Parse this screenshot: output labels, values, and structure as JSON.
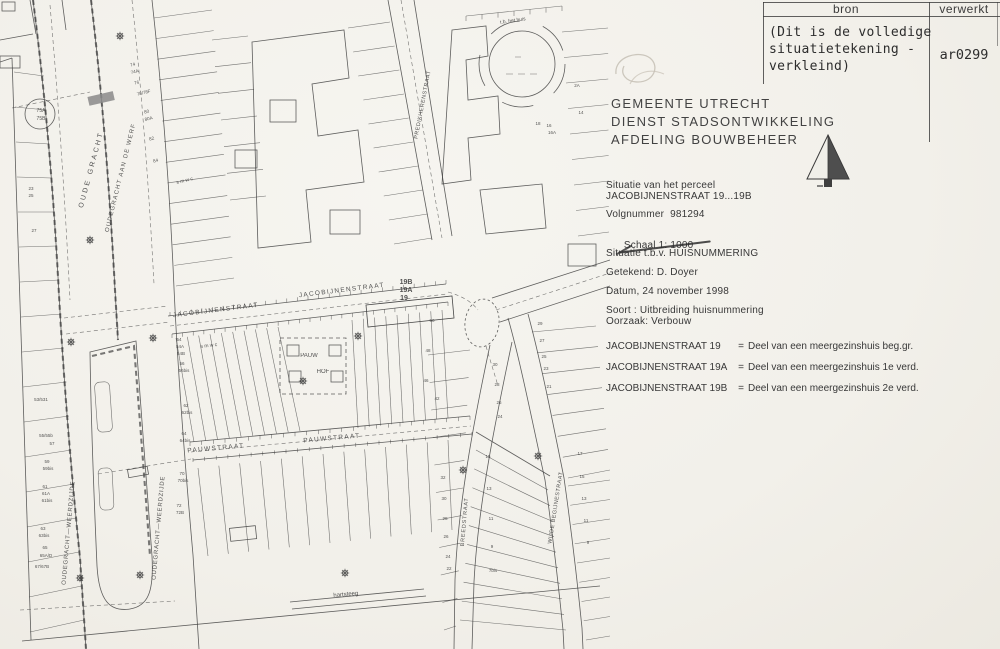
{
  "form": {
    "table": {
      "header_bron": "bron",
      "header_verwerkt": "verwerkt",
      "note_line1": "(Dit is de volledige",
      "note_line2": "situatietekening -",
      "note_line3": "verkleind)",
      "code": "ar0299"
    },
    "org_line1": "GEMEENTE  UTRECHT",
    "org_line2": "DIENST  STADSONTWIKKELING",
    "org_line3": "AFDELING  BOUWBEHEER",
    "north_arrow": "north-arrow-icon",
    "situatie_label": "Situatie van het perceel",
    "situatie_value": "JACOBIJNENSTRAAT 19...19B",
    "volgnummer": "Volgnummer  981294",
    "schaal_label": "Schaal",
    "schaal_value": "1: 1000",
    "tbv": "Situatie t.b.v. HUISNUMMERING",
    "getekend": "Getekend: D. Doyer",
    "datum": "Datum, 24 november 1998",
    "soort": "Soort : Uitbreiding huisnummering",
    "oorzaak": "Oorzaak: Verbouw",
    "entries": [
      {
        "addr": "JACOBIJNENSTRAAT 19",
        "sep": "=",
        "desc": "Deel van een meergezinshuis beg.gr."
      },
      {
        "addr": "JACOBIJNENSTRAAT 19A",
        "sep": "=",
        "desc": "Deel van een meergezinshuis 1e verd."
      },
      {
        "addr": "JACOBIJNENSTRAAT 19B",
        "sep": "=",
        "desc": "Deel van een meergezinshuis 2e verd."
      }
    ]
  },
  "map": {
    "ink": "#3c3c3c",
    "labels": [
      {
        "t": "OUDE GRACHT",
        "x": 93,
        "y": 170,
        "r": -75,
        "s": 7,
        "ls": 2.5
      },
      {
        "t": "OUDEGRACHT AAN DE WERF",
        "x": 122,
        "y": 178,
        "r": -76,
        "s": 6,
        "ls": 1.2
      },
      {
        "t": "OUDEGRACHT—WEERDZIJDE",
        "x": 70,
        "y": 533,
        "r": -85,
        "s": 6,
        "ls": 0.8
      },
      {
        "t": "OUDEGRACHT—WEERDZIJDE",
        "x": 160,
        "y": 528,
        "r": -85,
        "s": 6,
        "ls": 0.8
      },
      {
        "t": "JACOBIJNENSTRAAT",
        "x": 216,
        "y": 312,
        "r": -7,
        "s": 6.5,
        "ls": 1.3
      },
      {
        "t": "JACOBIJNENSTRAAT",
        "x": 342,
        "y": 292,
        "r": -7,
        "s": 6.5,
        "ls": 1.3
      },
      {
        "t": "PAUWSTRAAT",
        "x": 216,
        "y": 450,
        "r": -5,
        "s": 6.5,
        "ls": 1.3
      },
      {
        "t": "PAUWSTRAAT",
        "x": 332,
        "y": 440,
        "r": -5,
        "s": 6.5,
        "ls": 1.3
      },
      {
        "t": "PREDIKHERENSTRAAT",
        "x": 424,
        "y": 105,
        "r": -79,
        "s": 5.5,
        "ls": 0.5
      },
      {
        "t": "BREEDSTRAAT",
        "x": 466,
        "y": 522,
        "r": -85,
        "s": 5.5,
        "ls": 0.8
      },
      {
        "t": "WIJDE BEGIJNESTRAAT",
        "x": 557,
        "y": 508,
        "r": -81,
        "s": 5.5,
        "ls": 0.5
      },
      {
        "t": "hartsteeg",
        "x": 346,
        "y": 596,
        "r": -5,
        "s": 6
      },
      {
        "t": "PAUW",
        "x": 309,
        "y": 357,
        "s": 6
      },
      {
        "t": "HOF",
        "x": 323,
        "y": 373,
        "s": 6
      },
      {
        "t": "19B",
        "x": 406,
        "y": 284,
        "s": 7,
        "w": 700
      },
      {
        "t": "19A",
        "x": 406,
        "y": 292,
        "s": 7,
        "w": 700
      },
      {
        "t": "19",
        "x": 404,
        "y": 300,
        "s": 7,
        "w": 700
      },
      {
        "t": "t.b. het huis",
        "x": 513,
        "y": 22,
        "r": -8,
        "s": 5
      },
      {
        "t": "75A",
        "x": 41,
        "y": 112,
        "s": 5
      },
      {
        "t": "75B",
        "x": 41,
        "y": 120,
        "s": 5
      },
      {
        "t": "s m w c",
        "x": 185,
        "y": 182,
        "r": -14,
        "s": 5
      },
      {
        "t": "s m w c",
        "x": 209,
        "y": 347,
        "r": -7,
        "s": 5
      },
      {
        "t": "23",
        "x": 31,
        "y": 190,
        "s": 4.5
      },
      {
        "t": "25",
        "x": 31,
        "y": 197,
        "s": 4.5
      },
      {
        "t": "27",
        "x": 34,
        "y": 232,
        "s": 4.5
      },
      {
        "t": "53/531",
        "x": 41,
        "y": 401,
        "s": 4.5
      },
      {
        "t": "55/55b",
        "x": 46,
        "y": 437,
        "s": 4.5
      },
      {
        "t": "57",
        "x": 52,
        "y": 445,
        "s": 4.5
      },
      {
        "t": "59",
        "x": 47,
        "y": 463,
        "s": 4.5
      },
      {
        "t": "59bis",
        "x": 48,
        "y": 470,
        "s": 4.5
      },
      {
        "t": "61",
        "x": 45,
        "y": 488,
        "s": 4.5
      },
      {
        "t": "61A",
        "x": 46,
        "y": 495,
        "s": 4.5
      },
      {
        "t": "61bis",
        "x": 47,
        "y": 502,
        "s": 4.5
      },
      {
        "t": "63",
        "x": 43,
        "y": 530,
        "s": 4.5
      },
      {
        "t": "63bis",
        "x": 44,
        "y": 537,
        "s": 4.5
      },
      {
        "t": "65",
        "x": 45,
        "y": 549,
        "s": 4.5
      },
      {
        "t": "65A/D",
        "x": 46,
        "y": 557,
        "s": 4.5
      },
      {
        "t": "67/67B",
        "x": 42,
        "y": 568,
        "s": 4.5
      },
      {
        "t": "74",
        "x": 133,
        "y": 66,
        "r": -14,
        "s": 4.5
      },
      {
        "t": "74A",
        "x": 135,
        "y": 73,
        "r": -14,
        "s": 4.5
      },
      {
        "t": "76",
        "x": 137,
        "y": 84,
        "r": -14,
        "s": 4.5
      },
      {
        "t": "78/78F",
        "x": 144,
        "y": 94,
        "r": -14,
        "s": 4.5
      },
      {
        "t": "80",
        "x": 147,
        "y": 113,
        "r": -14,
        "s": 4.5
      },
      {
        "t": "80A",
        "x": 149,
        "y": 120,
        "r": -14,
        "s": 4.5
      },
      {
        "t": "82",
        "x": 152,
        "y": 140,
        "r": -14,
        "s": 4.5
      },
      {
        "t": "84",
        "x": 156,
        "y": 162,
        "r": -14,
        "s": 4.5
      },
      {
        "t": "54",
        "x": 179,
        "y": 341,
        "s": 4.5
      },
      {
        "t": "54A",
        "x": 180,
        "y": 348,
        "s": 4.5
      },
      {
        "t": "54B",
        "x": 181,
        "y": 355,
        "s": 4.5
      },
      {
        "t": "56",
        "x": 182,
        "y": 365,
        "s": 4.5
      },
      {
        "t": "56bis",
        "x": 184,
        "y": 372,
        "s": 4.5
      },
      {
        "t": "62",
        "x": 186,
        "y": 407,
        "s": 4.5
      },
      {
        "t": "62bis",
        "x": 187,
        "y": 414,
        "s": 4.5
      },
      {
        "t": "64",
        "x": 184,
        "y": 435,
        "s": 4.5
      },
      {
        "t": "64bis",
        "x": 185,
        "y": 442,
        "s": 4.5
      },
      {
        "t": "70",
        "x": 182,
        "y": 475,
        "s": 4.5
      },
      {
        "t": "70bis",
        "x": 183,
        "y": 482,
        "s": 4.5
      },
      {
        "t": "72",
        "x": 179,
        "y": 507,
        "s": 4.5
      },
      {
        "t": "72B",
        "x": 180,
        "y": 514,
        "s": 4.5
      },
      {
        "t": "50",
        "x": 432,
        "y": 322,
        "s": 4.5
      },
      {
        "t": "48",
        "x": 428,
        "y": 352,
        "s": 4.5
      },
      {
        "t": "46",
        "x": 426,
        "y": 382,
        "s": 4.5
      },
      {
        "t": "42",
        "x": 437,
        "y": 400,
        "s": 4.5
      },
      {
        "t": "30",
        "x": 495,
        "y": 366,
        "s": 4.5
      },
      {
        "t": "28",
        "x": 497,
        "y": 386,
        "s": 4.5
      },
      {
        "t": "26",
        "x": 499,
        "y": 404,
        "s": 4.5
      },
      {
        "t": "24",
        "x": 500,
        "y": 418,
        "s": 4.5
      },
      {
        "t": "29",
        "x": 540,
        "y": 325,
        "s": 4.5
      },
      {
        "t": "27",
        "x": 542,
        "y": 342,
        "s": 4.5
      },
      {
        "t": "25",
        "x": 544,
        "y": 358,
        "s": 4.5
      },
      {
        "t": "23",
        "x": 546,
        "y": 370,
        "s": 4.5
      },
      {
        "t": "21",
        "x": 549,
        "y": 388,
        "s": 4.5
      },
      {
        "t": "15",
        "x": 488,
        "y": 458,
        "s": 4.5
      },
      {
        "t": "13",
        "x": 489,
        "y": 490,
        "s": 4.5
      },
      {
        "t": "11",
        "x": 491,
        "y": 520,
        "s": 4.5
      },
      {
        "t": "9",
        "x": 492,
        "y": 548,
        "s": 4.5
      },
      {
        "t": "7bis",
        "x": 493,
        "y": 572,
        "s": 4.5
      },
      {
        "t": "17",
        "x": 580,
        "y": 455,
        "s": 4.5
      },
      {
        "t": "15",
        "x": 582,
        "y": 478,
        "s": 4.5
      },
      {
        "t": "13",
        "x": 584,
        "y": 500,
        "s": 4.5
      },
      {
        "t": "11",
        "x": 586,
        "y": 522,
        "s": 4.5
      },
      {
        "t": "9",
        "x": 588,
        "y": 544,
        "s": 4.5
      },
      {
        "t": "18",
        "x": 538,
        "y": 125,
        "s": 4.5
      },
      {
        "t": "16",
        "x": 549,
        "y": 127,
        "s": 4.5
      },
      {
        "t": "16A",
        "x": 552,
        "y": 134,
        "s": 4.5
      },
      {
        "t": "14",
        "x": 581,
        "y": 114,
        "s": 4.5
      },
      {
        "t": "2A",
        "x": 577,
        "y": 87,
        "s": 4.5
      },
      {
        "t": "32",
        "x": 443,
        "y": 479,
        "s": 4.5
      },
      {
        "t": "30",
        "x": 444,
        "y": 500,
        "s": 4.5
      },
      {
        "t": "28",
        "x": 445,
        "y": 520,
        "s": 4.5
      },
      {
        "t": "26",
        "x": 446,
        "y": 538,
        "s": 4.5
      },
      {
        "t": "24",
        "x": 448,
        "y": 558,
        "s": 4.5
      },
      {
        "t": "22",
        "x": 449,
        "y": 570,
        "s": 4.5
      }
    ],
    "trees": [
      [
        90,
        240
      ],
      [
        120,
        36
      ],
      [
        71,
        342
      ],
      [
        153,
        338
      ],
      [
        80,
        578
      ],
      [
        140,
        575
      ],
      [
        345,
        573
      ],
      [
        463,
        470
      ],
      [
        538,
        456
      ],
      [
        303,
        381
      ],
      [
        358,
        336
      ]
    ]
  }
}
